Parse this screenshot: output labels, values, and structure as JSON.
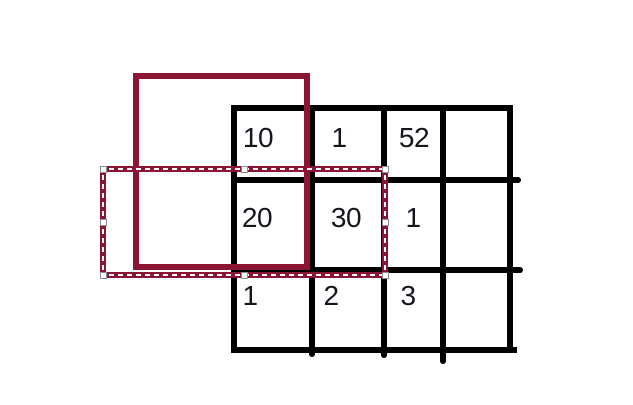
{
  "canvas": {
    "width": 633,
    "height": 405,
    "background": "#ffffff"
  },
  "colors": {
    "grid_line": "#000000",
    "shape_outline": "#8C1535",
    "selection_outline": "#8C1535",
    "selection_dash": "#ffffff",
    "handle_fill": "#ffffff",
    "handle_border": "#8f8f8f",
    "cell_text": "#15151d"
  },
  "grid": {
    "rows": 3,
    "cols": 4,
    "cells": [
      {
        "row": 0,
        "col": 0,
        "value": "10"
      },
      {
        "row": 0,
        "col": 1,
        "value": "1"
      },
      {
        "row": 0,
        "col": 2,
        "value": "52"
      },
      {
        "row": 0,
        "col": 3,
        "value": ""
      },
      {
        "row": 1,
        "col": 0,
        "value": "20"
      },
      {
        "row": 1,
        "col": 1,
        "value": "30"
      },
      {
        "row": 1,
        "col": 2,
        "value": "1"
      },
      {
        "row": 1,
        "col": 3,
        "value": ""
      },
      {
        "row": 2,
        "col": 0,
        "value": "1"
      },
      {
        "row": 2,
        "col": 1,
        "value": "2"
      },
      {
        "row": 2,
        "col": 2,
        "value": "3"
      },
      {
        "row": 2,
        "col": 3,
        "value": ""
      }
    ]
  },
  "shapes": {
    "solid_rectangle": {
      "type": "rectangle",
      "stroke": "#8C1535",
      "fill": "none"
    },
    "selection_rectangle": {
      "type": "selection-outline",
      "stroke": "#8C1535",
      "dash": "#ffffff",
      "handle_count": 8
    }
  }
}
